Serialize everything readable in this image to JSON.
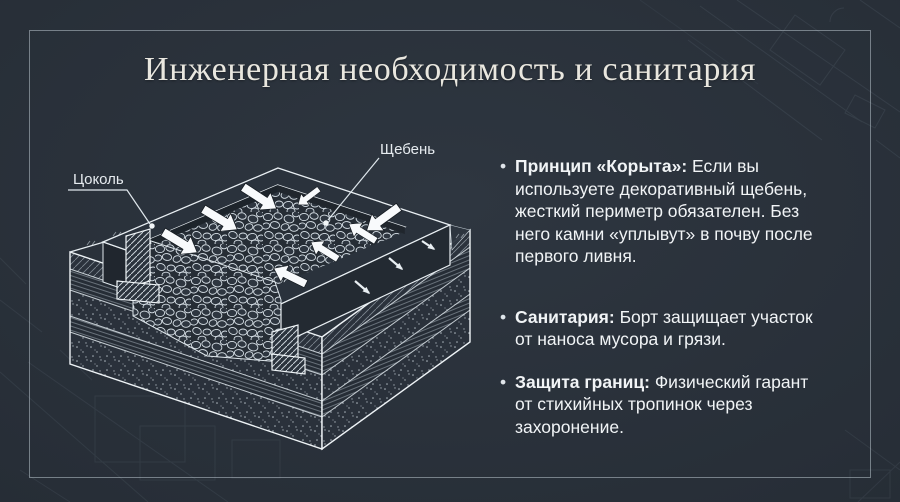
{
  "slide": {
    "title": "Инженерная необходимость и санитария"
  },
  "diagram": {
    "labels": {
      "plinth": "Цоколь",
      "gravel": "Щебень"
    }
  },
  "bullets": {
    "marker": "•",
    "items": [
      {
        "bold": "Принцип «Корыта»:",
        "first_line_rest": " Если вы",
        "lines": [
          "используете декоративный щебень,",
          "жесткий периметр обязателен. Без",
          "него камни «уплывут» в почву после",
          "первого ливня."
        ]
      },
      {
        "bold": "Санитария:",
        "first_line_rest": " Борт защищает участок",
        "lines": [
          "от наноса мусора и грязи."
        ]
      },
      {
        "bold": "Защита границ:",
        "first_line_rest": " Физический гарант",
        "lines": [
          "от стихийных тропинок через",
          "захоронение."
        ]
      }
    ]
  },
  "colors": {
    "background": "#272e37",
    "line_white": "#e8eef2",
    "body_text": "#f1f4f6",
    "title_text": "#e9e7df"
  }
}
